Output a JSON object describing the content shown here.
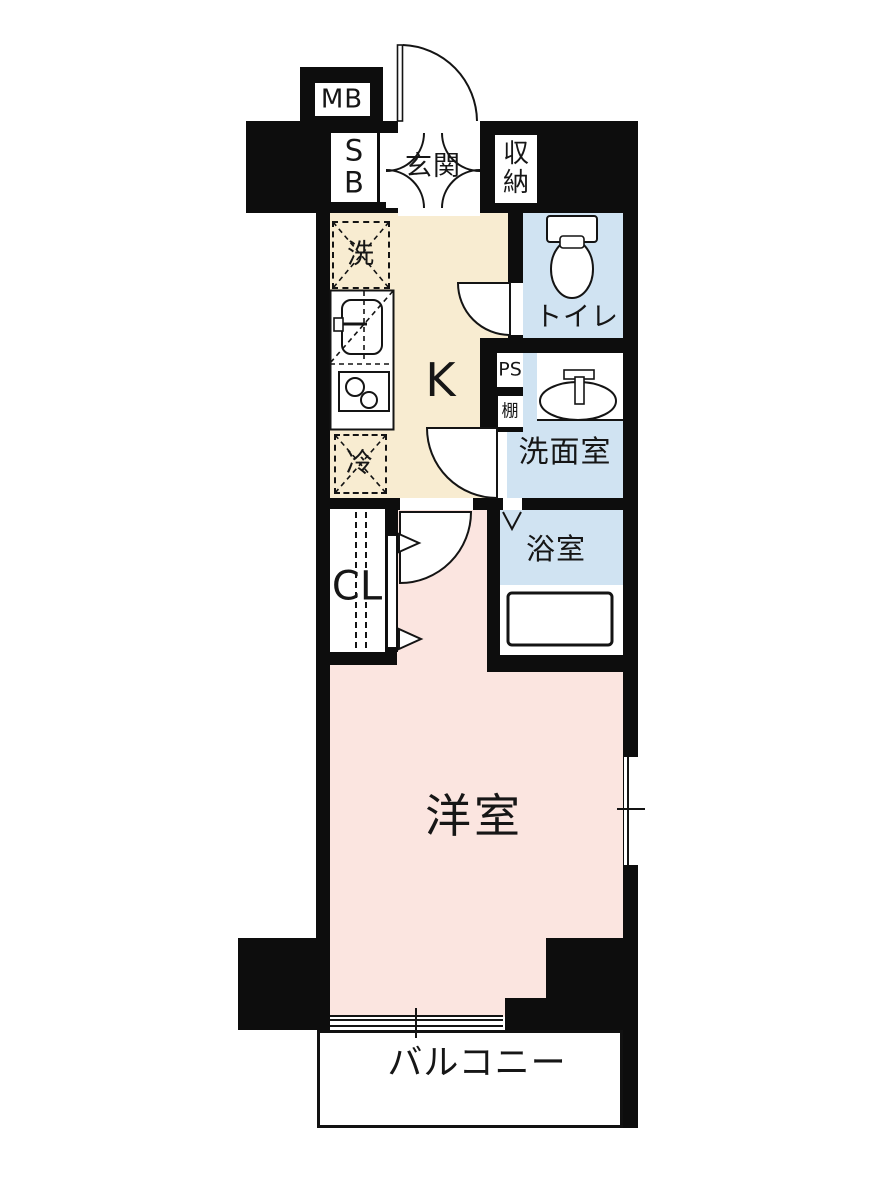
{
  "floorplan": {
    "type": "japanese-apartment-floor-plan",
    "background": "#ffffff",
    "colors": {
      "wall": "#0d0d0d",
      "kitchen": "#f8ecd1",
      "bedroom": "#fbe5e0",
      "wet_area": "#d0e3f2",
      "fixture": "#ffffff",
      "line": "#141414"
    },
    "labels": {
      "meter_box": "MB",
      "shoe_box": "SB",
      "entrance": "玄関",
      "storage": "収納",
      "washer": "洗",
      "kitchen": "K",
      "toilet": "トイレ",
      "pipe_space": "PS",
      "shelf": "棚",
      "washroom": "洗面室",
      "fridge": "冷",
      "closet": "CL",
      "bathroom": "浴室",
      "bedroom": "洋室",
      "balcony": "バルコニー"
    }
  }
}
